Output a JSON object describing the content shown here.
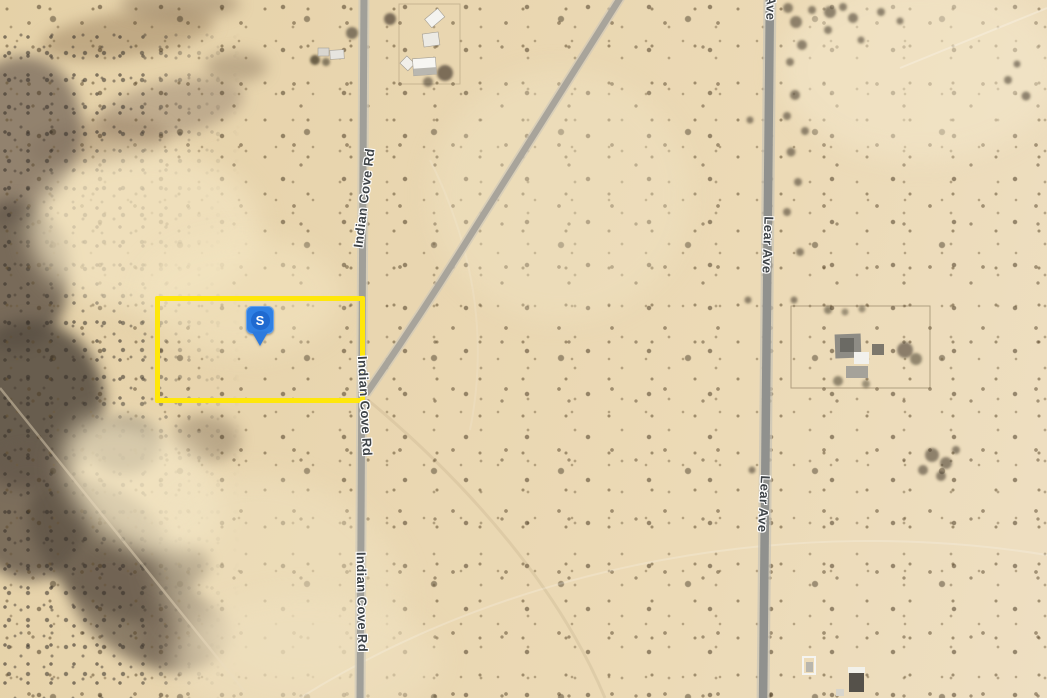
{
  "map": {
    "view_type": "satellite",
    "marker": {
      "label": "S",
      "color": "#2f80e4"
    },
    "parcel": {
      "outline_color": "#ffe70a"
    },
    "colors": {
      "sand": "#e9d6b0",
      "road": "#9b9b95",
      "label_text": "#3e4347"
    },
    "road_labels": [
      {
        "id": "indian-cove-rd-north",
        "text": "Indian Cove Rd"
      },
      {
        "id": "indian-cove-rd-mid",
        "text": "Indian Cove Rd"
      },
      {
        "id": "indian-cove-rd-south",
        "text": "Indian Cove Rd"
      },
      {
        "id": "lear-ave-north",
        "text": "Lear Ave"
      },
      {
        "id": "lear-ave-mid",
        "text": "Lear Ave"
      },
      {
        "id": "ave-top-partial",
        "text": "Ave"
      }
    ]
  }
}
